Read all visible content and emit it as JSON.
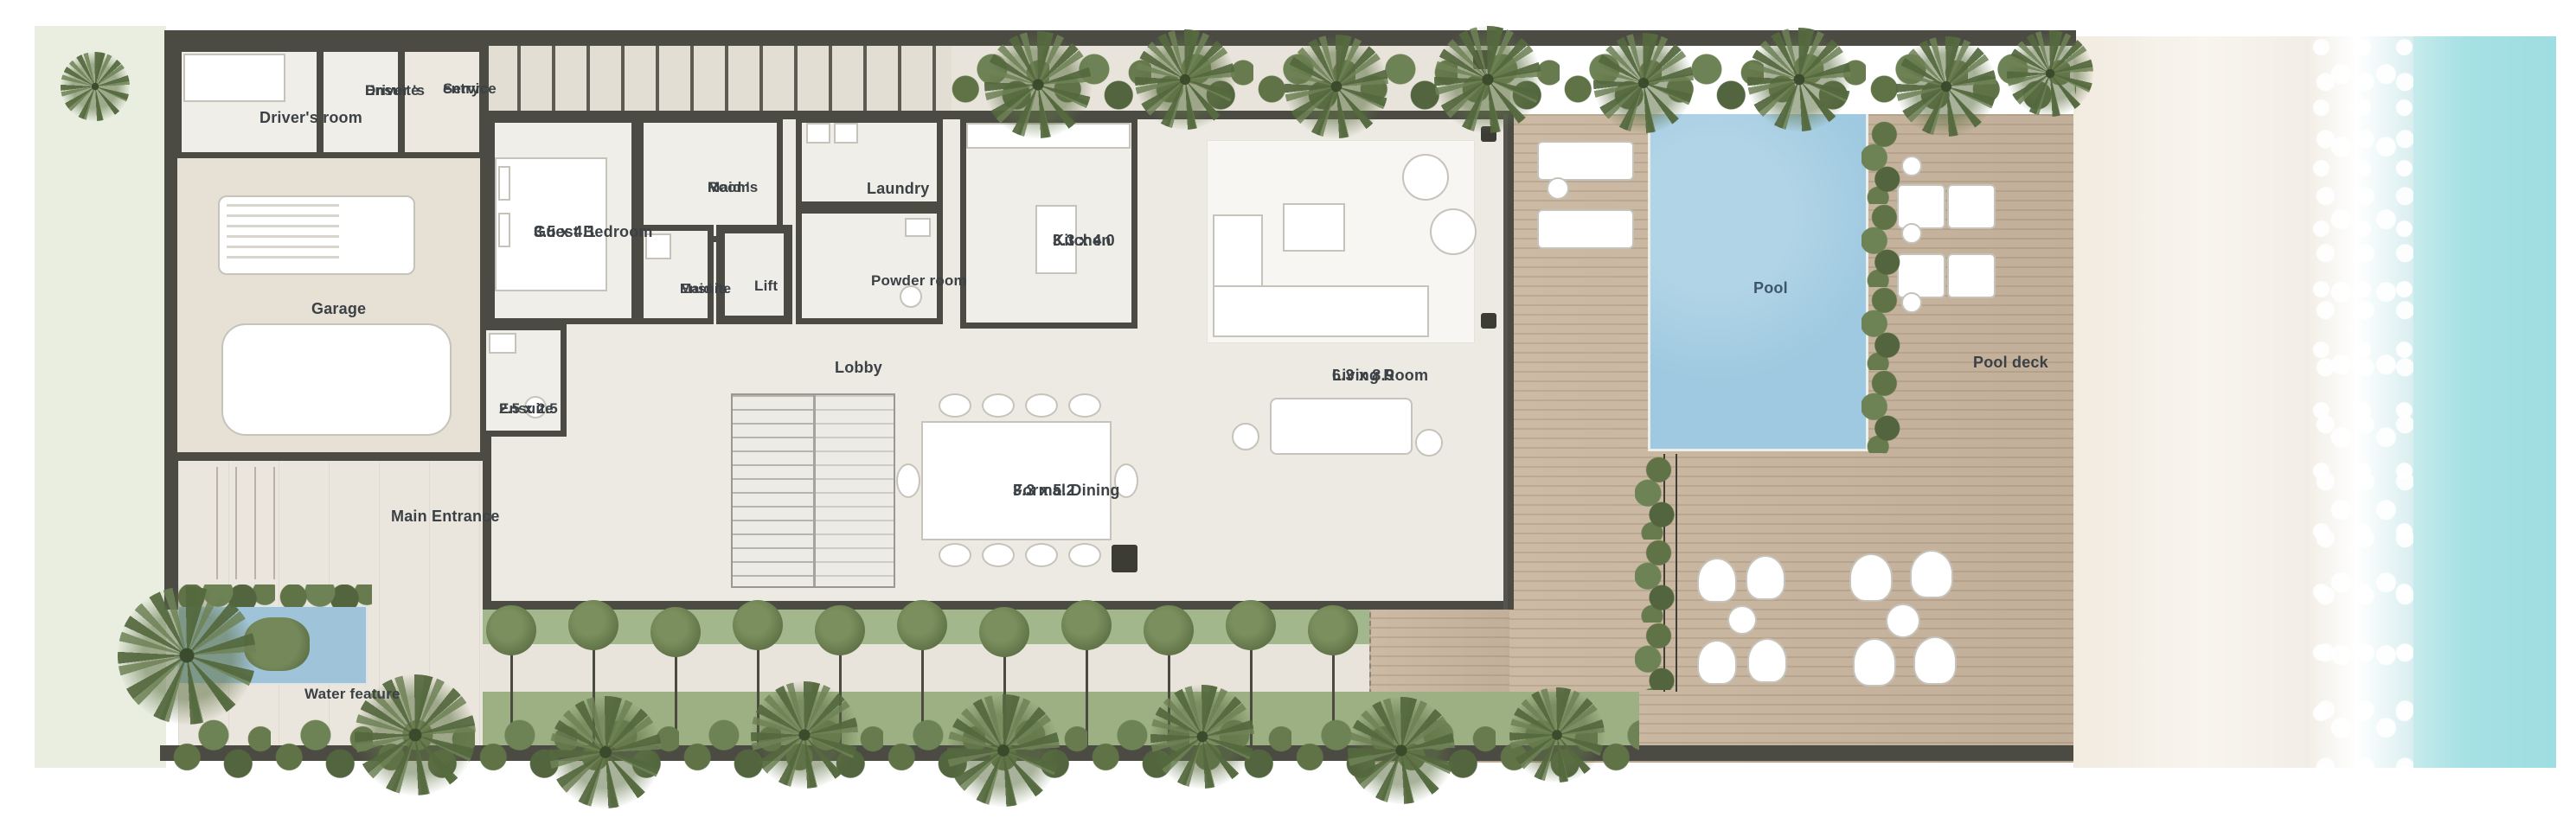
{
  "plan": {
    "type": "beachfront villa ground floor plan",
    "rooms": [
      {
        "id": "drivers-room",
        "lines": [
          "Driver's room"
        ]
      },
      {
        "id": "drivers-ensuite",
        "lines": [
          "Driver 's",
          "Ensuite"
        ]
      },
      {
        "id": "service-entry",
        "lines": [
          "Service",
          "entry"
        ]
      },
      {
        "id": "guest-bedroom",
        "lines": [
          "Guest Bedroom",
          "3.5 x 4.1"
        ]
      },
      {
        "id": "maids-room",
        "lines": [
          "Maid 's",
          "Room"
        ]
      },
      {
        "id": "laundry",
        "lines": [
          "Laundry"
        ]
      },
      {
        "id": "maids-ensuite",
        "lines": [
          "Maid 's",
          "Ensuite"
        ]
      },
      {
        "id": "lift",
        "lines": [
          "Lift"
        ]
      },
      {
        "id": "powder-room",
        "lines": [
          "Powder room"
        ]
      },
      {
        "id": "kitchen",
        "lines": [
          "Kitchen",
          "3.3 x 4.0"
        ]
      },
      {
        "id": "lobby",
        "lines": [
          "Lobby"
        ]
      },
      {
        "id": "ensuite",
        "lines": [
          "Ensuite",
          "2.5 x 2.5"
        ]
      },
      {
        "id": "garage",
        "lines": [
          "Garage"
        ]
      },
      {
        "id": "formal-dining",
        "lines": [
          "Formal Dining",
          "3.3 x 5.2"
        ]
      },
      {
        "id": "living-room",
        "lines": [
          "Living Room",
          "6.3 x 8.9"
        ]
      },
      {
        "id": "main-entrance",
        "lines": [
          "Main Entrance"
        ]
      },
      {
        "id": "water-feature",
        "lines": [
          "Water feature"
        ]
      },
      {
        "id": "pool",
        "lines": [
          "Pool"
        ]
      },
      {
        "id": "pool-deck",
        "lines": [
          "Pool deck"
        ]
      }
    ]
  },
  "colors": {
    "wall": "#4b4a43",
    "floor": "#edeae3",
    "pavement": "#e9e4db",
    "deck": "#c8b6a0",
    "pool": "#9ec9e0",
    "water_feature": "#9fc3d8",
    "lawn": "#a3b78c",
    "sand": "#f5f0e8",
    "sea": "#a7e1e4",
    "label": "#3b4145",
    "left_lawn": "#e9eee1"
  }
}
